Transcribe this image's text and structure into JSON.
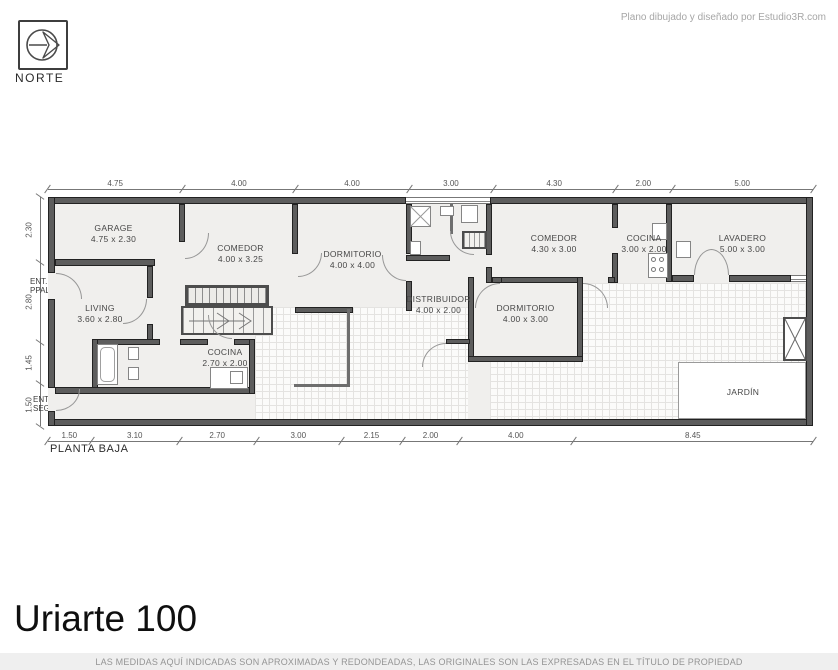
{
  "credit": "Plano dibujado y diseñado por Estudio3R.com",
  "north": {
    "label": "NORTE"
  },
  "title": "Uriarte 100",
  "plan_label": "PLANTA BAJA",
  "disclaimer": "LAS MEDIDAS AQUÍ INDICADAS SON APROXIMADAS Y REDONDEADAS, LAS ORIGINALES SON LAS EXPRESADAS EN EL TÍTULO DE PROPIEDAD",
  "entrances": {
    "ppal": [
      "ENT.",
      "PPAL."
    ],
    "seg": [
      "ENT.",
      "SEG."
    ]
  },
  "rooms": [
    {
      "name": "GARAGE",
      "size": "4.75 x 2.30"
    },
    {
      "name": "COMEDOR",
      "size": "4.00 x 3.25"
    },
    {
      "name": "DORMITORIO",
      "size": "4.00 x 4.00"
    },
    {
      "name": "COMEDOR",
      "size": "4.30 x 3.00"
    },
    {
      "name": "COCINA",
      "size": "3.00 x 2.00"
    },
    {
      "name": "LAVADERO",
      "size": "5.00 x 3.00"
    },
    {
      "name": "LIVING",
      "size": "3.60 x 2.80"
    },
    {
      "name": "DISTRIBUIDOR",
      "size": "4.00 x 2.00"
    },
    {
      "name": "DORMITORIO",
      "size": "4.00 x 3.00"
    },
    {
      "name": "COCINA",
      "size": "2.70 x 2.00"
    },
    {
      "name": "JARDÍN",
      "size": ""
    }
  ],
  "dimensions": {
    "top": [
      "4.75",
      "4.00",
      "4.00",
      "3.00",
      "4.30",
      "2.00",
      "5.00"
    ],
    "left": [
      "2.30",
      "2.80",
      "1.45",
      "1.50"
    ],
    "bottom": [
      "1.50",
      "3.10",
      "2.70",
      "3.00",
      "2.15",
      "2.00",
      "4.00",
      "8.45"
    ]
  },
  "icons": {
    "north": "north-arrow-icon"
  },
  "colors": {
    "wall": "#5d5d5d",
    "floor": "#f0efed",
    "paper": "#ffffff",
    "dim_line": "#777777"
  }
}
